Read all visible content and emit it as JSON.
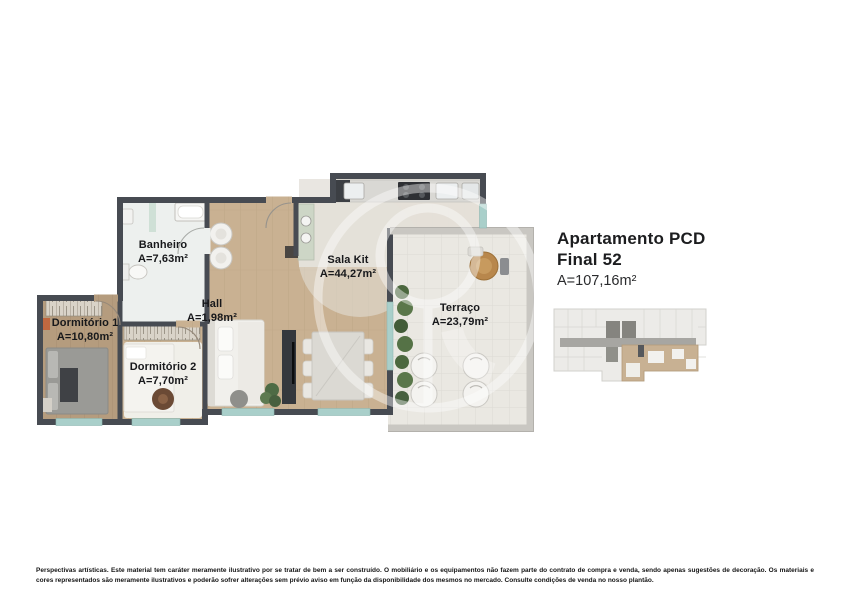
{
  "header": {
    "title_line1": "Apartamento PCD",
    "title_line2": "Final 52",
    "area": "A=107,16m²"
  },
  "floorplan": {
    "rooms": [
      {
        "name": "Banheiro",
        "area": "A=7,63m²"
      },
      {
        "name": "Hall",
        "area": "A=1,98m²"
      },
      {
        "name": "Sala Kit",
        "area": "A=44,27m²"
      },
      {
        "name": "Terraço",
        "area": "A=23,79m²"
      },
      {
        "name": "Dormitório 1",
        "area": "A=10,80m²"
      },
      {
        "name": "Dormitório 2",
        "area": "A=7,70m²"
      }
    ]
  },
  "footer": {
    "disclaimer": "Perspectivas artísticas. Este material tem caráter meramente ilustrativo por se tratar de bem a ser construído. O mobiliário e os equipamentos não fazem parte do contrato de compra e venda, sendo apenas sugestões de decoração. Os materiais e cores representados são meramente ilustrativos e poderão sofrer alterações sem prévio aviso em função da disponibilidade dos mesmos no mercado. Consulte condições de venda no nosso plantão."
  },
  "colors": {
    "wall": "#474b52",
    "wood_floor": "#c9b192",
    "wood_floor_dark": "#b59c7e",
    "terrace_tile": "#eae8e2",
    "bath_floor": "#edf0ee",
    "window_glass": "#a9cfca",
    "parapet": "#c9c7c2",
    "keyplan_highlight": "#c8b193",
    "label_text": "#17181b"
  }
}
